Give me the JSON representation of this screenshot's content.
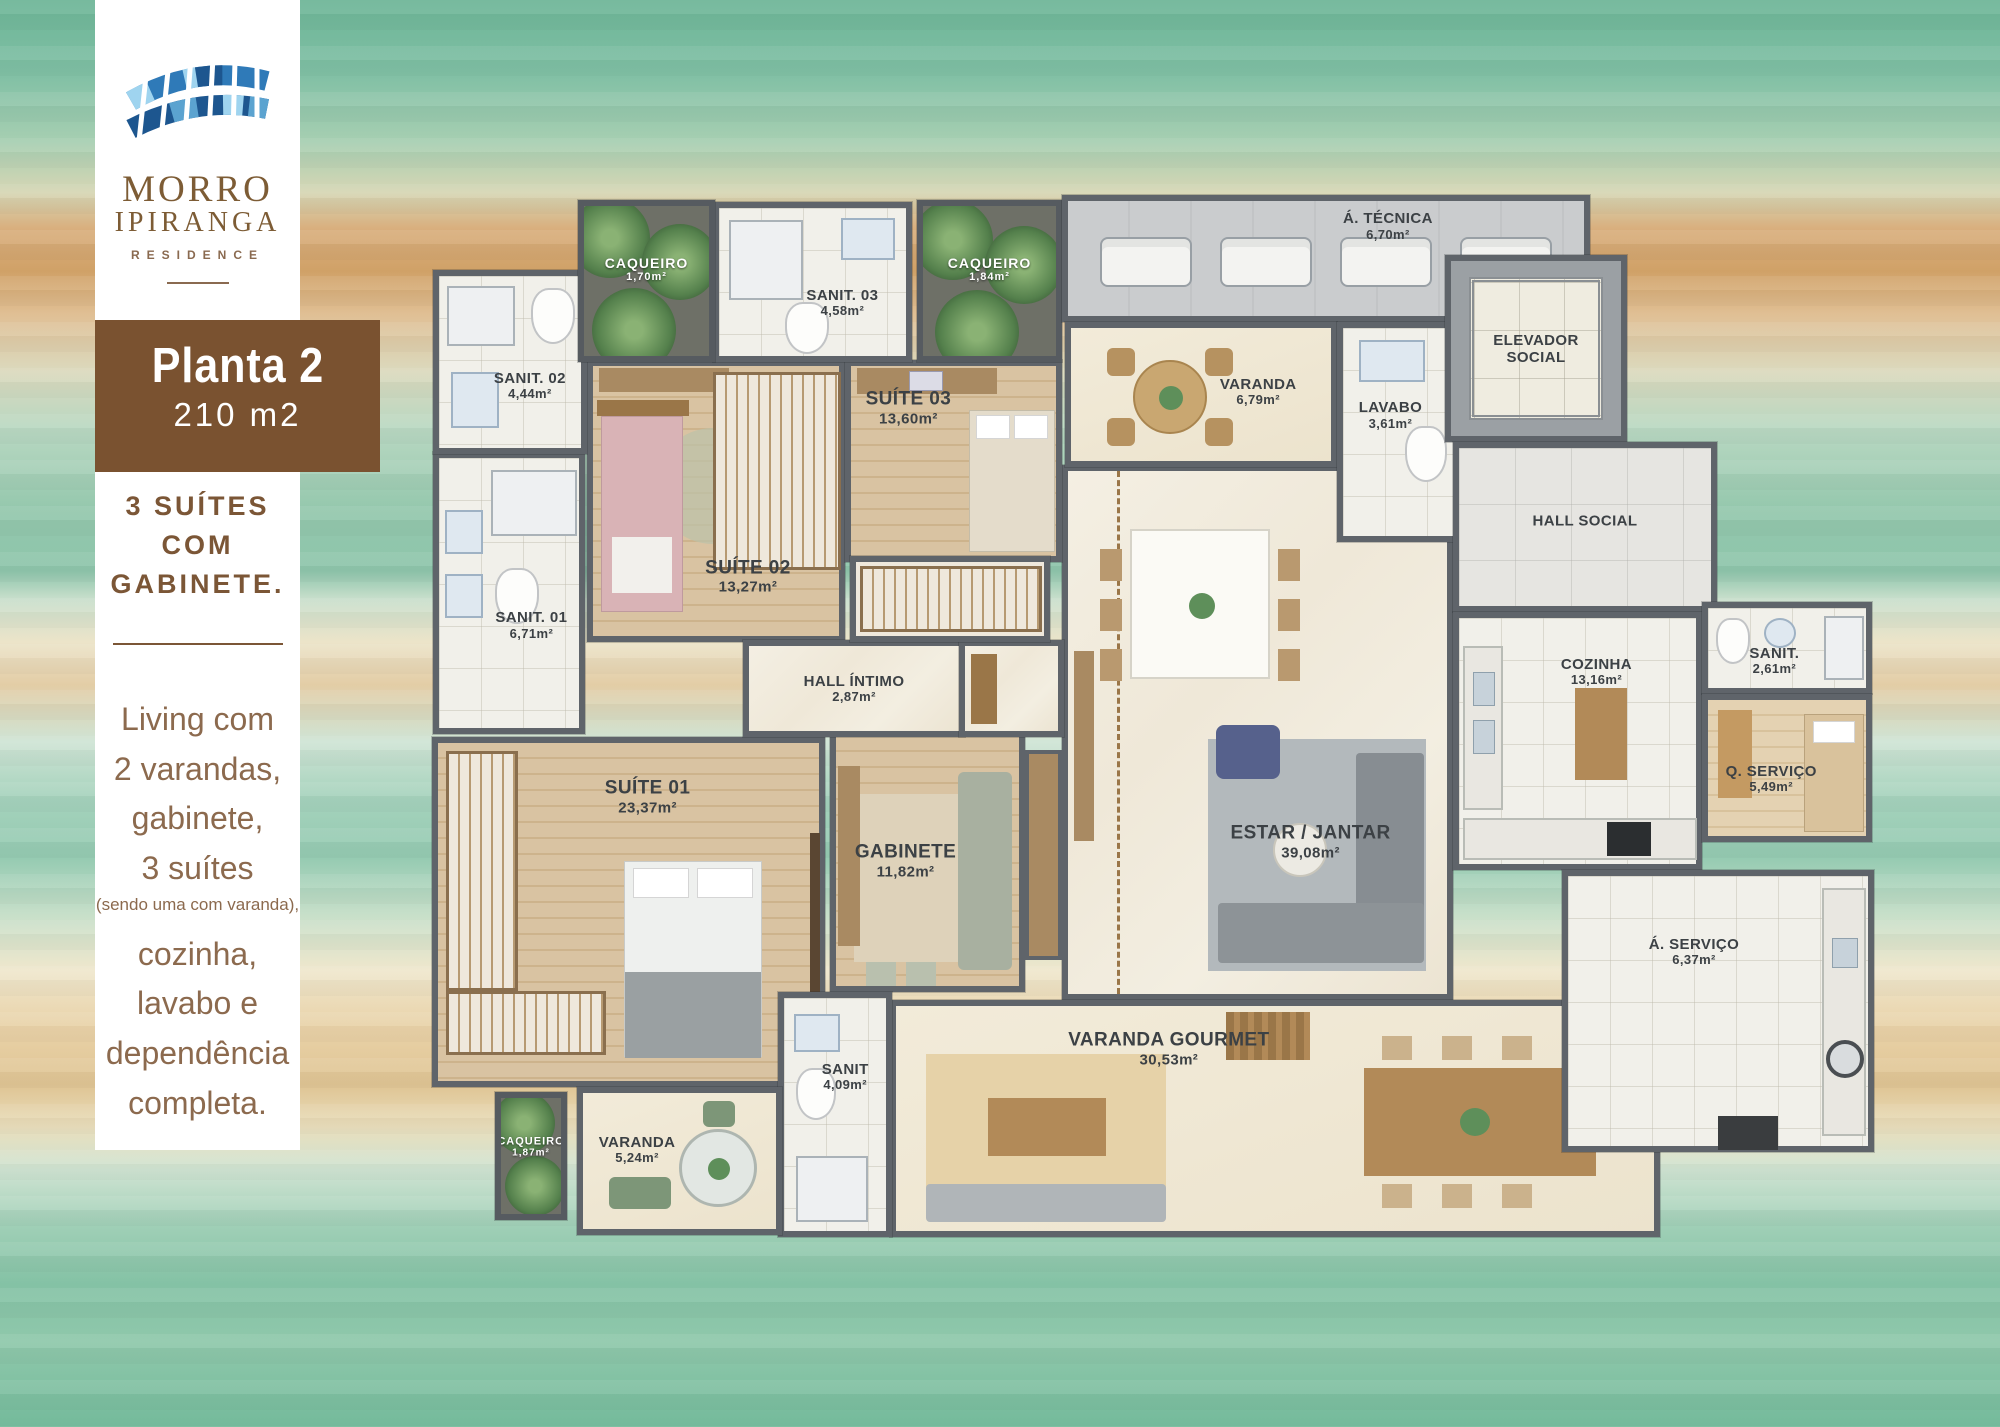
{
  "brand": {
    "name_line1": "MORRO",
    "name_line2": "IPIRANGA",
    "subtitle": "RESIDENCE"
  },
  "sidebar": {
    "plan_title": "Planta 2",
    "plan_area": "210 m2",
    "headline_line1": "3 SUÍTES",
    "headline_line2": "COM",
    "headline_line3": "GABINETE.",
    "desc_line1": "Living com",
    "desc_line2": "2 varandas,",
    "desc_line3": "gabinete,",
    "desc_line4": "3 suítes",
    "desc_note": "(sendo uma com varanda),",
    "desc_line5": "cozinha,",
    "desc_line6": "lavabo e",
    "desc_line7": "dependência",
    "desc_line8": "completa."
  },
  "palette": {
    "brand_brown": "#7a5230",
    "text_brown": "#8c6a4e",
    "logo_blue_dark": "#1d568f",
    "logo_blue_mid": "#2f7ab8",
    "logo_blue_light": "#9fd4ef",
    "wall_gray": "#5f646a"
  },
  "floorplan": {
    "rooms": [
      {
        "id": "estar-jantar",
        "label": "ESTAR / JANTAR",
        "area": "39,08m²"
      },
      {
        "id": "varanda-gourmet",
        "label": "VARANDA GOURMET",
        "area": "30,53m²"
      },
      {
        "id": "suite-01",
        "label": "SUÍTE 01",
        "area": "23,37m²"
      },
      {
        "id": "gabinete",
        "label": "GABINETE",
        "area": "11,82m²"
      },
      {
        "id": "suite-02",
        "label": "SUÍTE 02",
        "area": "13,27m²"
      },
      {
        "id": "suite-03",
        "label": "SUÍTE 03",
        "area": "13,60m²"
      },
      {
        "id": "hall-intimo",
        "label": "HALL ÍNTIMO",
        "area": "2,87m²"
      },
      {
        "id": "sanit-01",
        "label": "SANIT. 01",
        "area": "6,71m²"
      },
      {
        "id": "sanit-02",
        "label": "SANIT. 02",
        "area": "4,44m²"
      },
      {
        "id": "sanit-03",
        "label": "SANIT. 03",
        "area": "4,58m²"
      },
      {
        "id": "caqueiro-top-left",
        "label": "CAQUEIRO",
        "area": "1,70m²"
      },
      {
        "id": "caqueiro-top-right",
        "label": "CAQUEIRO",
        "area": "1,84m²"
      },
      {
        "id": "area-tecnica",
        "label": "Á. TÉCNICA",
        "area": "6,70m²"
      },
      {
        "id": "varanda-social",
        "label": "VARANDA",
        "area": "6,79m²"
      },
      {
        "id": "lavabo",
        "label": "LAVABO",
        "area": "3,61m²"
      },
      {
        "id": "elevador-social",
        "label": "ELEVADOR SOCIAL",
        "area": ""
      },
      {
        "id": "hall-social",
        "label": "HALL SOCIAL",
        "area": ""
      },
      {
        "id": "cozinha",
        "label": "COZINHA",
        "area": "13,16m²"
      },
      {
        "id": "sanit-servico",
        "label": "SANIT.",
        "area": "2,61m²"
      },
      {
        "id": "quarto-servico",
        "label": "Q. SERVIÇO",
        "area": "5,49m²"
      },
      {
        "id": "area-servico",
        "label": "Á. SERVIÇO",
        "area": "6,37m²"
      },
      {
        "id": "sanit-suite01",
        "label": "SANIT",
        "area": "4,09m²"
      },
      {
        "id": "varanda-suite01",
        "label": "VARANDA",
        "area": "5,24m²"
      },
      {
        "id": "caqueiro-bottom",
        "label": "CAQUEIRO",
        "area": "1,87m²"
      }
    ]
  }
}
